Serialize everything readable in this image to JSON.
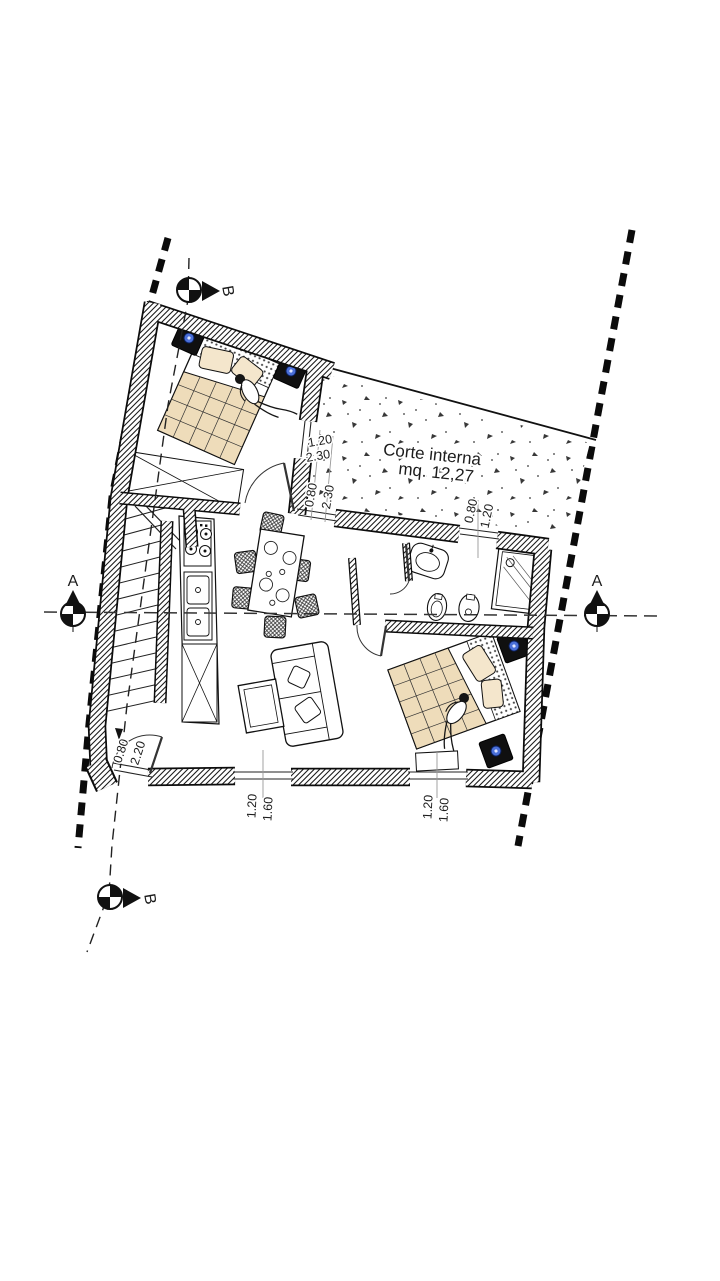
{
  "drawing": {
    "courtyard": {
      "name": "Corte interna",
      "area": "mq. 12,27"
    },
    "sections": {
      "a": "A",
      "b": "B"
    },
    "dimensions": {
      "bedroom1_window": {
        "w": "1.20",
        "h": "2.30"
      },
      "courtyard_door": {
        "w": "0.80",
        "h": "2.30"
      },
      "bathroom_window": {
        "w": "0.80",
        "h": "1.20"
      },
      "entrance_door": {
        "w": "0.80",
        "h": "2.20"
      },
      "living_window": {
        "w": "1.20",
        "h": "1.60"
      },
      "bedroom2_window": {
        "w": "1.20",
        "h": "1.60"
      }
    },
    "colors": {
      "wood": "#eedcba",
      "wood_light": "#f4e6cc",
      "accent_blue": "#4a6fd8",
      "line": "#111111"
    }
  }
}
